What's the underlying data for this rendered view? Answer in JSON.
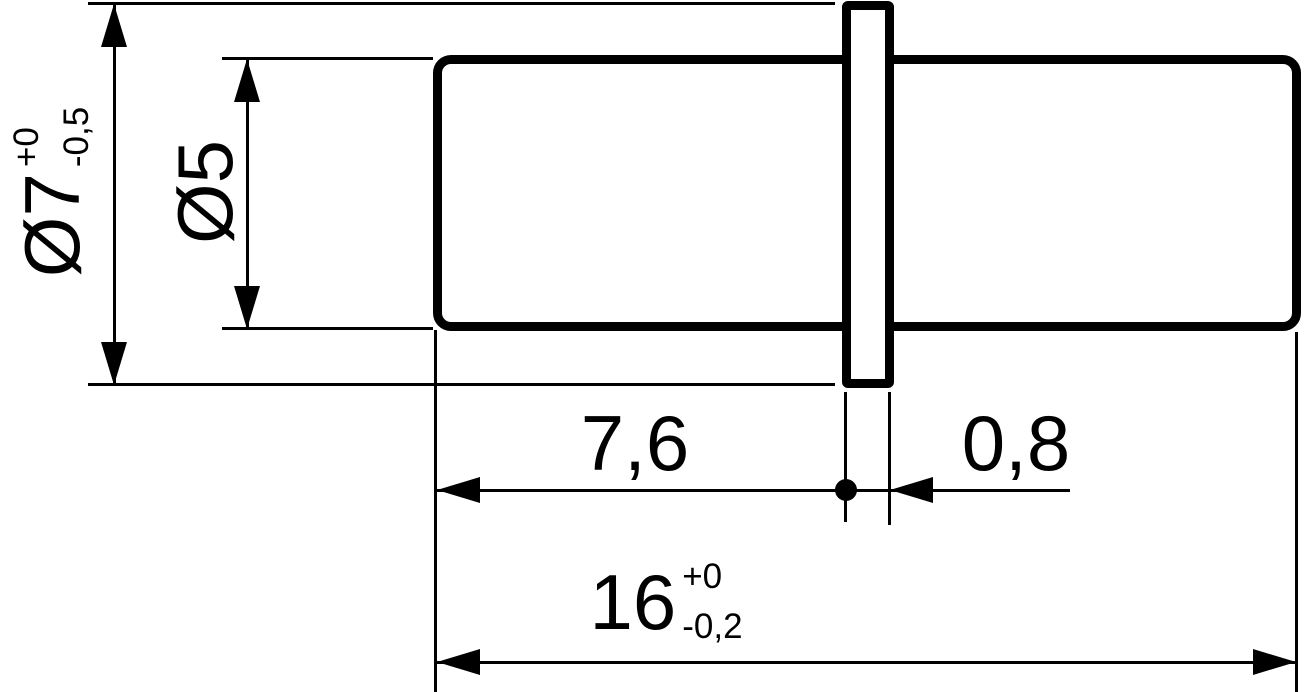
{
  "colors": {
    "ink": "#000000",
    "background": "#ffffff"
  },
  "dimensions": {
    "flange_diameter": {
      "label": "Ø7",
      "tol_plus": "+0",
      "tol_minus": "-0,5"
    },
    "shaft_diameter": {
      "label": "Ø5"
    },
    "length_to_flange": {
      "label": "7,6"
    },
    "flange_thickness": {
      "label": "0,8"
    },
    "overall_length": {
      "label": "16",
      "tol_plus": "+0",
      "tol_minus": "-0,2"
    }
  }
}
